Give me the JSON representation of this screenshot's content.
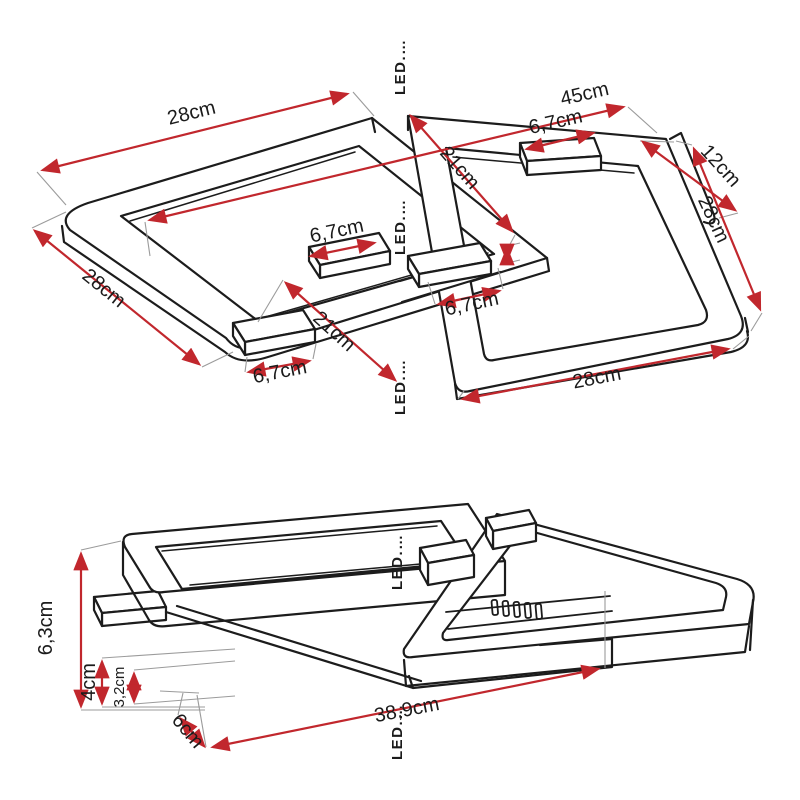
{
  "colors": {
    "dimension_red": "#c1272d",
    "line_black": "#1c1c1c",
    "extension_gray": "#9b9b9b",
    "watermark_gray": "#dadada"
  },
  "watermark": {
    "text": "LED.…"
  },
  "views": {
    "top": {
      "name": "top-perspective-view",
      "dims": [
        {
          "id": "width-top-left",
          "label": "28cm"
        },
        {
          "id": "total-length",
          "label": "45cm"
        },
        {
          "id": "tab-top",
          "label": "6,7cm"
        },
        {
          "id": "depth-inner-top",
          "label": "21cm"
        },
        {
          "id": "strip-right",
          "label": "12cm"
        },
        {
          "id": "side-right",
          "label": "28cm"
        },
        {
          "id": "side-left",
          "label": "28cm"
        },
        {
          "id": "tab-center",
          "label": "6,7cm"
        },
        {
          "id": "tab-mid-right",
          "label": "6,7cm"
        },
        {
          "id": "depth-inner-mid",
          "label": "21cm"
        },
        {
          "id": "tab-bottom-left",
          "label": "6,7cm"
        },
        {
          "id": "width-bottom",
          "label": "28cm"
        }
      ]
    },
    "side": {
      "name": "side-perspective-view",
      "dims": [
        {
          "id": "height-total",
          "label": "6,3cm"
        },
        {
          "id": "height-canopy",
          "label": "4cm"
        },
        {
          "id": "height-plate",
          "label": "3,2cm"
        },
        {
          "id": "depth-plate",
          "label": "6cm"
        },
        {
          "id": "length-total",
          "label": "38,9cm"
        }
      ]
    }
  }
}
